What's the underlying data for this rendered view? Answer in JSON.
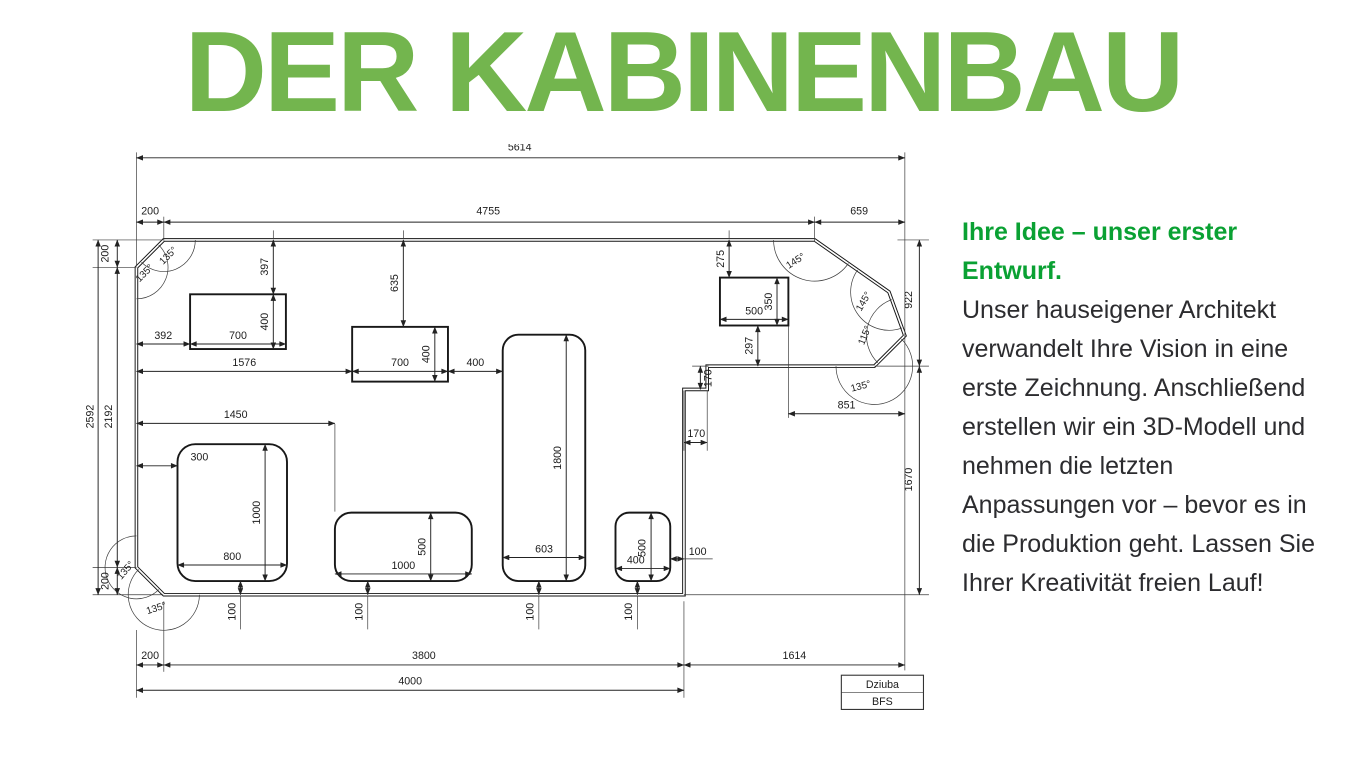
{
  "page": {
    "title": "DER KABINENBAU"
  },
  "colors": {
    "title_green": "#73b54e",
    "accent_green": "#0aa133",
    "body_text": "#2c2c2f",
    "line": "#1c1c1c"
  },
  "panel": {
    "heading": "Ihre Idee – unser erster Entwurf.",
    "body": "Unser hauseigener Architekt verwandelt Ihre Vision in eine erste Zeichnung. Anschließend erstellen wir ein 3D-Modell und nehmen die letzten Anpassungen vor – bevor es in die Produktion geht. Lassen Sie Ihrer Kreativität freien Lauf!"
  },
  "drawing": {
    "dims": {
      "overall_width": "5614",
      "top_chamfer_width": "200",
      "top_edge": "4755",
      "top_right_section": "659",
      "left_total": "2592",
      "left_wall": "2192",
      "left_chamfer_top": "200",
      "left_chamfer_bottom": "200",
      "right_upper": "922",
      "right_lower": "1670",
      "bottom_chamfer": "200",
      "bottom_edge": "3800",
      "bottom_right_section": "1614",
      "bottom_total": "4000",
      "angle_top_left_a": "135°",
      "angle_top_left_b": "135°",
      "angle_bottom_left_a": "135°",
      "angle_bottom_left_b": "135°",
      "angle_top_right_a": "145°",
      "angle_top_right_b": "145°",
      "angle_right": "115°",
      "angle_right_lower": "135°",
      "rect1_offset_left": "392",
      "rect1_width": "700",
      "rect1_offset_top": "397",
      "rect1_height": "400",
      "rect2_offset_left": "1576",
      "rect2_offset_top": "635",
      "rect2_width": "700",
      "rect2_height": "400",
      "rect2_gap_right": "400",
      "tall_rect_width": "603",
      "tall_rect_height": "1800",
      "rect3_offset_top": "275",
      "rect3_width": "500",
      "rect3_height": "350",
      "rect3_offset_bottom": "297",
      "step_height": "170",
      "step_depth": "170",
      "ledge_width": "851",
      "rect4_width": "400",
      "rect4_height": "500",
      "rect4_gap_right": "100",
      "rect5_offset_left": "300",
      "rect5_width": "800",
      "rect5_height": "1000",
      "rect6_offset_left": "1450",
      "rect6_width": "1000",
      "rect6_height": "500",
      "bottom_gap_1": "100",
      "bottom_gap_2": "100",
      "bottom_gap_3": "100",
      "bottom_gap_4": "100"
    },
    "title_block": {
      "row1": "Dziuba",
      "row2": "BFS"
    }
  }
}
